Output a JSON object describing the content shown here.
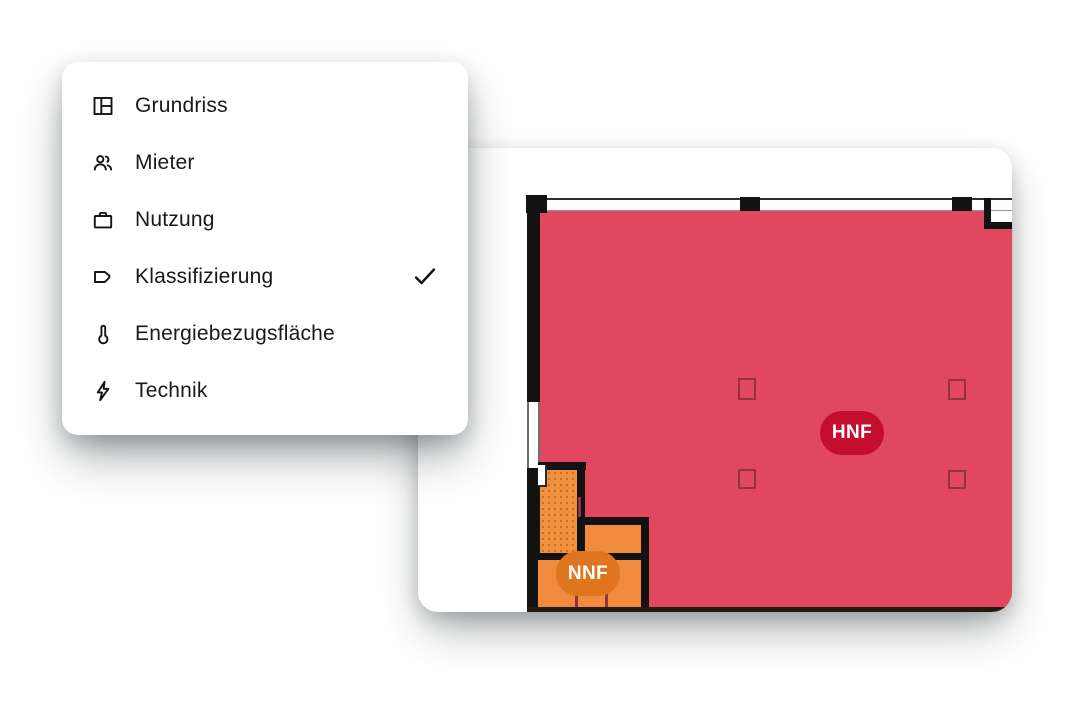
{
  "menu": {
    "items": [
      {
        "label": "Grundriss",
        "icon": "floorplan-icon",
        "checked": false
      },
      {
        "label": "Mieter",
        "icon": "tenants-icon",
        "checked": false
      },
      {
        "label": "Nutzung",
        "icon": "briefcase-icon",
        "checked": false
      },
      {
        "label": "Klassifizierung",
        "icon": "tag-icon",
        "checked": true
      },
      {
        "label": "Energiebezugsfläche",
        "icon": "thermometer-icon",
        "checked": false
      },
      {
        "label": "Technik",
        "icon": "lightning-icon",
        "checked": false
      }
    ]
  },
  "floorplan": {
    "badges": {
      "hnf": "HNF",
      "nnf": "NNF"
    },
    "colors": {
      "hnf_area": "#E1485F",
      "hnf_badge": "#C40E2D",
      "nnf_area": "#F08A3C",
      "nnf_badge": "#DF751E",
      "wall": "#121212",
      "pillar_outline": "#96323E"
    }
  }
}
